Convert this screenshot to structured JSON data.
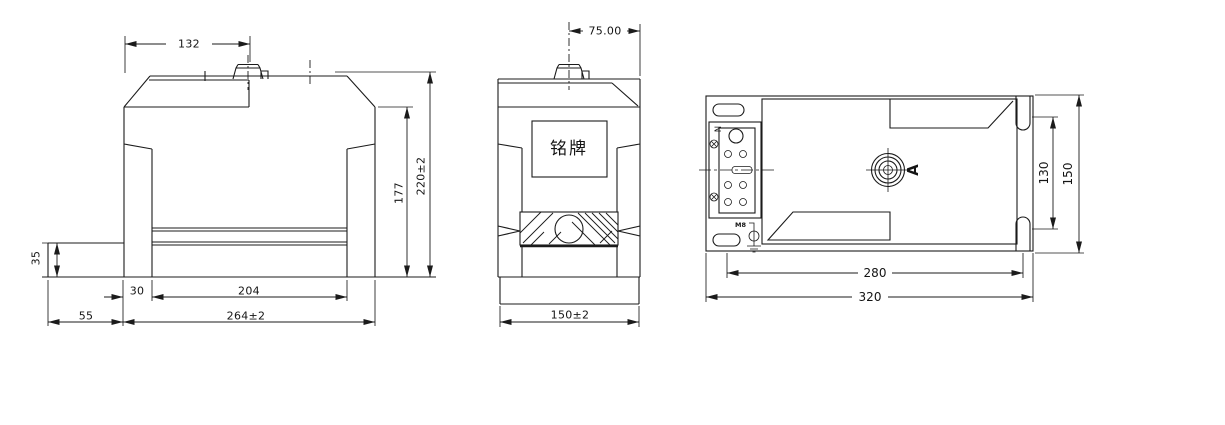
{
  "front_view": {
    "dim_top_width": "132",
    "dim_base_step_height": "35",
    "dim_leg_width": "30",
    "dim_rail_span": "204",
    "dim_left_extension": "55",
    "dim_overall_width": "264±2",
    "dim_window_height": "177",
    "dim_overall_height": "220±2"
  },
  "side_view": {
    "dim_terminal_offset": "75.00",
    "dim_overall_depth": "150±2",
    "nameplate_label": "铭牌"
  },
  "top_view": {
    "terminal_label": "N",
    "ground_bolt_label": "M8",
    "view_direction_label": "A",
    "dim_slot_spacing": "130",
    "dim_flange_depth": "150",
    "dim_mount_hole_span": "280",
    "dim_overall_length": "320"
  },
  "colors": {
    "line_color": "#1b1b1b",
    "background": "#ffffff"
  }
}
